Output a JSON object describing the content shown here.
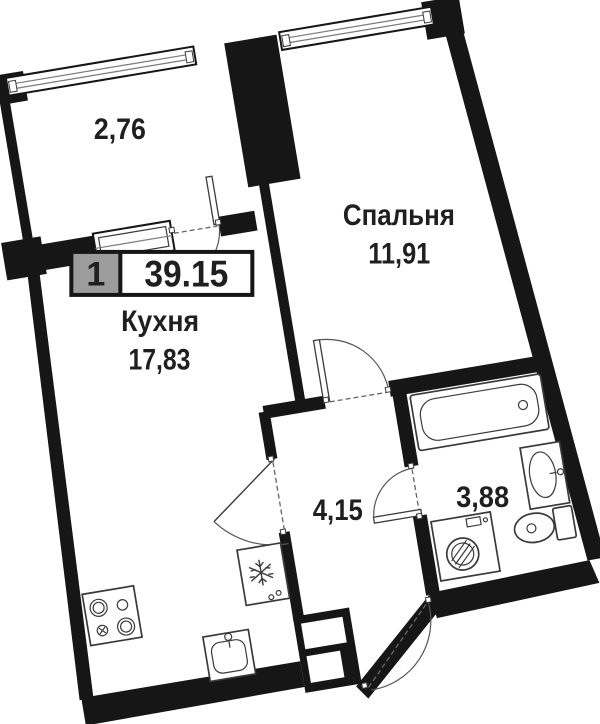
{
  "plan": {
    "badge": {
      "rooms_count": "1",
      "total_area": "39.15"
    },
    "rooms": [
      {
        "id": "balcony",
        "area": "2,76"
      },
      {
        "id": "bedroom",
        "name": "Спальня",
        "area": "11,91"
      },
      {
        "id": "kitchen",
        "name": "Кухня",
        "area": "17,83"
      },
      {
        "id": "hallway",
        "area": "4,15"
      },
      {
        "id": "bathroom",
        "area": "3,88"
      }
    ],
    "colors": {
      "wall": "#161616",
      "fixture_line": "#3a3a3a",
      "door_line": "#555555",
      "badge_gray": "#9c9c9c",
      "text": "#1f1f1f",
      "background": "#ffffff"
    }
  }
}
